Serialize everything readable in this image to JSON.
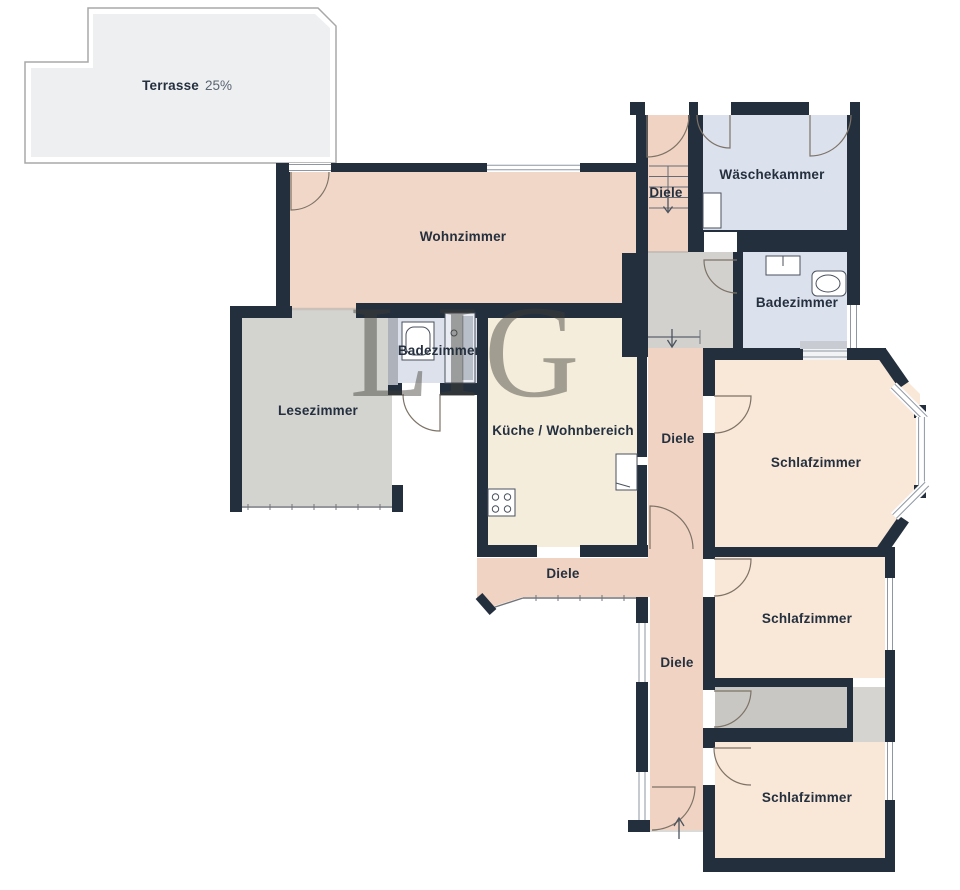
{
  "plan": {
    "watermark": "LIG",
    "rooms": {
      "terrasse": {
        "label": "Terrasse",
        "share": "25%"
      },
      "wohnzimmer": {
        "label": "Wohnzimmer"
      },
      "waeschekammer": {
        "label": "Wäschekammer"
      },
      "diele_treppe": {
        "label": "Diele"
      },
      "badezimmer_gross": {
        "label": "Badezimmer"
      },
      "badezimmer_klein": {
        "label": "Badezimmer"
      },
      "lesezimmer": {
        "label": "Lesezimmer"
      },
      "kueche": {
        "label": "Küche / Wohnbereich"
      },
      "diele_mitte": {
        "label": "Diele"
      },
      "diele_flur": {
        "label": "Diele"
      },
      "diele_unten": {
        "label": "Diele"
      },
      "schlafzimmer_1": {
        "label": "Schlafzimmer"
      },
      "schlafzimmer_2": {
        "label": "Schlafzimmer"
      },
      "schlafzimmer_3": {
        "label": "Schlafzimmer"
      }
    },
    "colors": {
      "wall": "#242f3e",
      "living_peach": "#f1d7c7",
      "hall_peach": "#f0d3c2",
      "bedroom_cream": "#f9e7d7",
      "kitchen_cream": "#f4eddc",
      "bath_blue": "#dce1ee",
      "reading_gray": "#d3d3d0",
      "landing_gray": "#d2d1cd",
      "closet_gray": "#c8c7c3",
      "terrace_gray": "#edeff1",
      "label_navy": "#25303f"
    }
  }
}
